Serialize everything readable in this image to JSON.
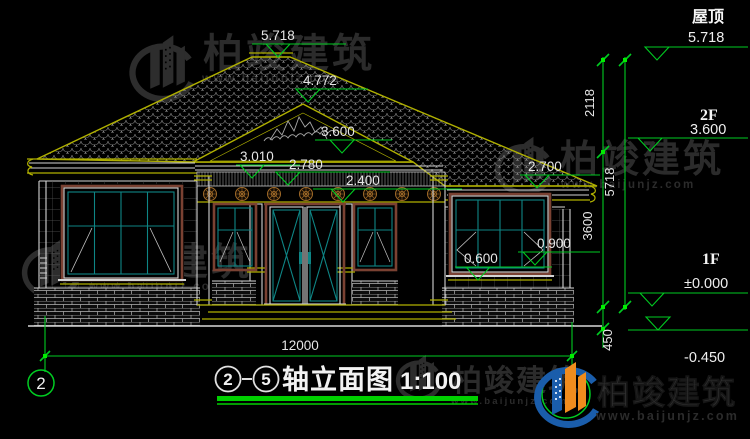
{
  "watermark": {
    "company": "柏竣建筑",
    "website": "www.baijunjz.com"
  },
  "title": {
    "axis_start": "2",
    "axis_end": "5",
    "text": "轴立面图",
    "scale": "1:100"
  },
  "axes": {
    "left_bubble": "2"
  },
  "levels": {
    "roof_label": "屋顶",
    "roof_value": "5.718",
    "f2_label": "2F",
    "f2_value": "3.600",
    "f1_label": "1F",
    "f1_value": "±0.000",
    "ground_value": "-0.450"
  },
  "marks": {
    "ridge": "5.718",
    "gable_peak": "4.772",
    "gable_base": "3.600",
    "left_eave": "3.010",
    "porch_beam": "2.780",
    "door_top": "2.400",
    "right_eave": "2.700",
    "window_sill": "0.900",
    "parapet": "0.600"
  },
  "vdims": {
    "roof": "2118",
    "total": "5718",
    "floor": "3600",
    "plinth": "450"
  },
  "hdim": {
    "total_width": "12000"
  },
  "colors": {
    "dim_green": "#00cc22",
    "cad_yellow": "#b0b000",
    "sash_teal": "#0e8585",
    "frame_maroon": "#7a4132",
    "logo_blue": "#1a5dab",
    "logo_orange": "#f08c1e"
  }
}
